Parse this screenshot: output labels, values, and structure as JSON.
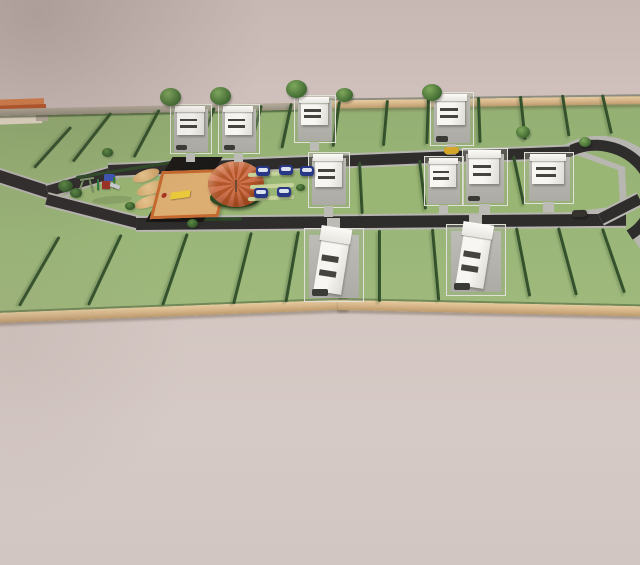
{
  "meta": {
    "type": "3d-architectural-site-plan-render",
    "content": "aerial perspective render of a residential subdivision with green plots, a road loop, houses, playground and parking"
  },
  "palette": {
    "background_top": "#c7b8b4",
    "background_bottom": "#d6cac6",
    "grass": "#9cb77a",
    "island_grass": "#9ab674",
    "hedge_green": "#2d4a28",
    "hedge_light": "#3a5a30",
    "road_asphalt": "#2f2c2c",
    "sidewalk": "#b8b6b0",
    "wall_tan": "#d9b386",
    "wall_gray": "#aba394",
    "house_white": "#f6f5f1",
    "house_pad": "#b6b5af",
    "window_dark": "#45443f",
    "umbrella_orange": "#cf7350",
    "umbrella_dark": "#b2572a",
    "sand": "#dcae72",
    "sand_frame": "#c4692f",
    "court_black": "#1b1917",
    "car_blue": "#283786",
    "car_glass": "#dde3ee",
    "car_yellow": "#d3a528",
    "car_dark": "#36332f",
    "tree_green": "#4f7c3c",
    "entry_roof_orange": "#bf5a2c",
    "bench_yellow": "#e9c83a"
  },
  "counts": {
    "houses": 10,
    "blue_cars": 5,
    "trees": 7,
    "bushes": 6,
    "plot_hedges": 29
  },
  "roads": [
    {
      "id": "entrance",
      "x": -6,
      "y": 168,
      "w": 64,
      "h": 12,
      "rot": 18
    },
    {
      "id": "upper-west",
      "x": 46,
      "y": 186,
      "w": 72,
      "h": 11,
      "rot": -16
    },
    {
      "id": "upper-main",
      "x": 108,
      "y": 165,
      "w": 462,
      "h": 11,
      "rot": -2.3
    },
    {
      "id": "lower-west",
      "x": 48,
      "y": 194,
      "w": 98,
      "h": 11,
      "rot": 14.5
    },
    {
      "id": "lower-main",
      "x": 136,
      "y": 218,
      "w": 490,
      "h": 12,
      "rot": -0.5
    },
    {
      "id": "east-link",
      "x": 598,
      "y": 214,
      "w": 44,
      "h": 11,
      "rot": -27
    }
  ],
  "walls": [
    {
      "id": "north-west",
      "x": -2,
      "y": 109,
      "w": 310,
      "h": 7,
      "rot": -1.2,
      "tone": "gray"
    },
    {
      "id": "north-east",
      "x": 300,
      "y": 101,
      "w": 344,
      "h": 8,
      "rot": -0.8,
      "tone": "tan"
    },
    {
      "id": "south-west",
      "x": -4,
      "y": 313,
      "w": 352,
      "h": 10,
      "rot": -2.2,
      "tone": "tan"
    },
    {
      "id": "south-east",
      "x": 338,
      "y": 300,
      "w": 306,
      "h": 10,
      "rot": 1.2,
      "tone": "tan"
    }
  ],
  "houses": [
    {
      "id": "top-1",
      "x": 170,
      "y": 104,
      "w": 42,
      "h": 50,
      "variant": "standard",
      "drive": "bottom",
      "car": true
    },
    {
      "id": "top-2",
      "x": 218,
      "y": 104,
      "w": 42,
      "h": 50,
      "variant": "standard",
      "drive": "bottom",
      "car": true
    },
    {
      "id": "top-3",
      "x": 294,
      "y": 95,
      "w": 42,
      "h": 48,
      "variant": "standard",
      "drive": "bottom",
      "car": false
    },
    {
      "id": "top-4",
      "x": 430,
      "y": 92,
      "w": 44,
      "h": 54,
      "variant": "standard",
      "drive": "bottom",
      "car": true
    },
    {
      "id": "mid-1",
      "x": 308,
      "y": 152,
      "w": 42,
      "h": 56,
      "variant": "standard",
      "drive": "bottom",
      "car": false
    },
    {
      "id": "mid-2",
      "x": 424,
      "y": 156,
      "w": 40,
      "h": 50,
      "variant": "standard",
      "drive": "bottom",
      "car": false
    },
    {
      "id": "mid-3",
      "x": 462,
      "y": 148,
      "w": 46,
      "h": 58,
      "variant": "standard",
      "drive": "bottom",
      "car": true
    },
    {
      "id": "mid-4",
      "x": 524,
      "y": 152,
      "w": 50,
      "h": 52,
      "variant": "standard",
      "drive": "bottom",
      "car": false
    },
    {
      "id": "south-1",
      "x": 304,
      "y": 228,
      "w": 60,
      "h": 74,
      "variant": "long",
      "drive": "top",
      "car": true
    },
    {
      "id": "south-2",
      "x": 446,
      "y": 224,
      "w": 60,
      "h": 72,
      "variant": "long",
      "drive": "top",
      "car": true
    }
  ],
  "hedges": [
    [
      70,
      126,
      55,
      42
    ],
    [
      110,
      112,
      62,
      38
    ],
    [
      158,
      109,
      54,
      28
    ],
    [
      213,
      107,
      48,
      21
    ],
    [
      260,
      105,
      46,
      15
    ],
    [
      290,
      103,
      46,
      12
    ],
    [
      338,
      101,
      46,
      8
    ],
    [
      386,
      100,
      46,
      5
    ],
    [
      427,
      98,
      46,
      2
    ],
    [
      477,
      97,
      46,
      -2
    ],
    [
      519,
      96,
      44,
      -6
    ],
    [
      561,
      95,
      42,
      -9
    ],
    [
      601,
      95,
      40,
      -13
    ],
    [
      358,
      162,
      52,
      -3
    ],
    [
      418,
      160,
      50,
      -7
    ],
    [
      512,
      156,
      50,
      -12
    ],
    [
      58,
      236,
      80,
      30
    ],
    [
      120,
      234,
      78,
      25
    ],
    [
      186,
      233,
      76,
      19
    ],
    [
      250,
      232,
      74,
      14
    ],
    [
      297,
      231,
      72,
      10
    ],
    [
      378,
      230,
      72,
      0
    ],
    [
      431,
      229,
      72,
      -5
    ],
    [
      515,
      228,
      70,
      -11
    ],
    [
      557,
      228,
      70,
      -15
    ],
    [
      601,
      229,
      68,
      -19
    ]
  ],
  "island_edges": [
    {
      "x": 76,
      "y": 176,
      "len": 118,
      "rot": -9
    },
    {
      "x": 150,
      "y": 219,
      "len": 92,
      "rot": -1
    }
  ],
  "trees": [
    [
      160,
      88,
      21
    ],
    [
      210,
      87,
      21
    ],
    [
      286,
      80,
      21
    ],
    [
      336,
      88,
      17
    ],
    [
      422,
      84,
      20
    ],
    [
      516,
      126,
      14
    ],
    [
      579,
      137,
      12
    ]
  ],
  "bushes": [
    [
      58,
      180,
      15
    ],
    [
      70,
      188,
      12
    ],
    [
      102,
      148,
      11
    ],
    [
      125,
      202,
      10
    ],
    [
      187,
      219,
      11
    ],
    [
      296,
      184,
      9
    ]
  ],
  "cars_blue": [
    [
      256,
      166
    ],
    [
      279,
      165
    ],
    [
      300,
      166
    ],
    [
      254,
      188
    ],
    [
      277,
      187
    ]
  ],
  "car_yellow": {
    "x": 444,
    "y": 147
  },
  "car_dark": {
    "x": 572,
    "y": 210
  },
  "parking_marks": [
    [
      248,
      172,
      42
    ],
    [
      250,
      184,
      44
    ],
    [
      248,
      196,
      46
    ]
  ],
  "playground": {
    "black_courts": [
      [
        168,
        157,
        50,
        16
      ],
      [
        150,
        205,
        58,
        17
      ]
    ],
    "sandpit": {
      "x": 156,
      "y": 170,
      "w": 62,
      "h": 42
    },
    "dunes": [
      [
        132,
        170,
        28,
        11
      ],
      [
        136,
        182,
        32,
        12
      ],
      [
        134,
        196,
        30,
        11
      ]
    ],
    "umbrella": {
      "x": 208,
      "y": 161,
      "w": 56,
      "h": 46
    },
    "umbrella_bush": {
      "x": 210,
      "y": 188,
      "w": 50,
      "h": 20
    },
    "pole": {
      "x": 235,
      "y": 180,
      "h": 12
    },
    "equipment": {
      "x": 96,
      "y": 172
    },
    "swing": {
      "x": 80,
      "y": 178
    },
    "equipment_shadow": {
      "x": 92,
      "y": 196,
      "w": 40,
      "h": 8
    }
  }
}
